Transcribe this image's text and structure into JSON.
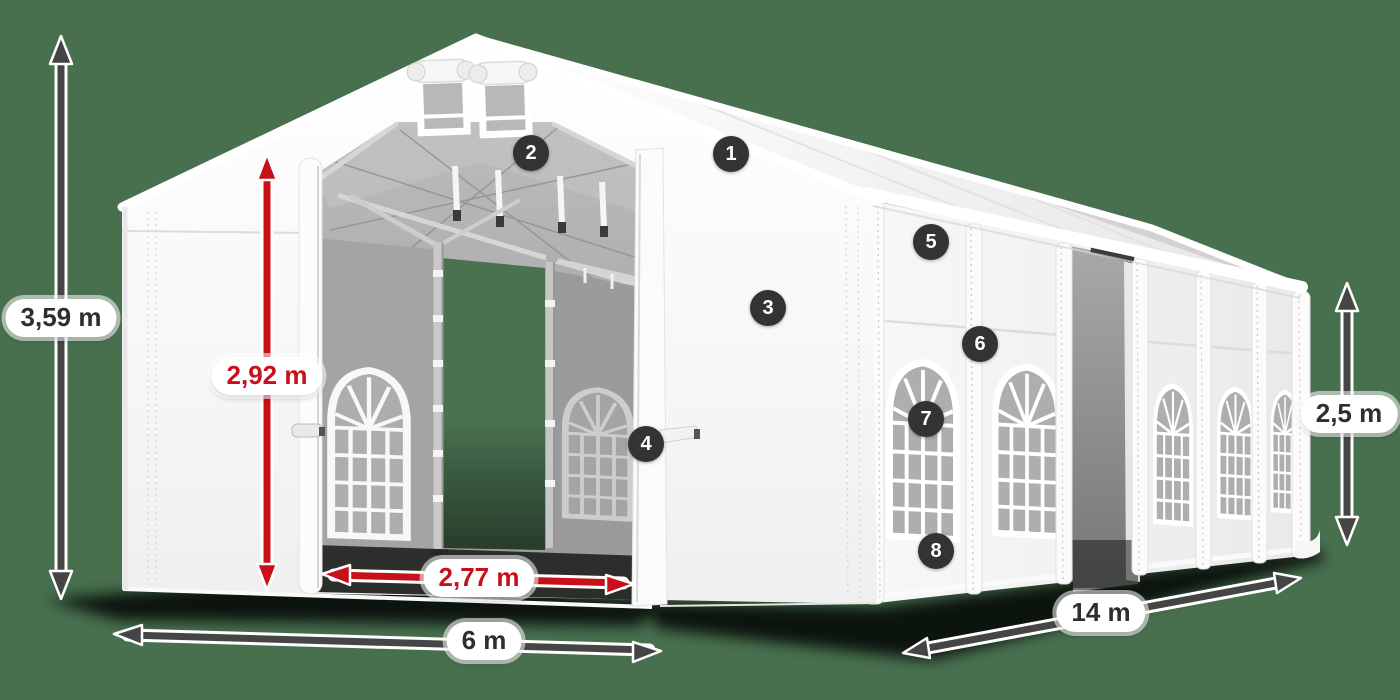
{
  "dimensions": {
    "total_height": "3,59 m",
    "inner_height": "2,92 m",
    "entrance_width": "2,77 m",
    "width": "6 m",
    "length": "14 m",
    "side_height": "2,5 m"
  },
  "callouts": [
    "1",
    "2",
    "3",
    "4",
    "5",
    "6",
    "7",
    "8"
  ],
  "colors": {
    "background": "#48704f",
    "accent_red": "#c8101b",
    "dimension_dark": "#454545",
    "badge_background": "#333333",
    "badge_text": "#ffffff",
    "tent_white": "#ffffff"
  }
}
